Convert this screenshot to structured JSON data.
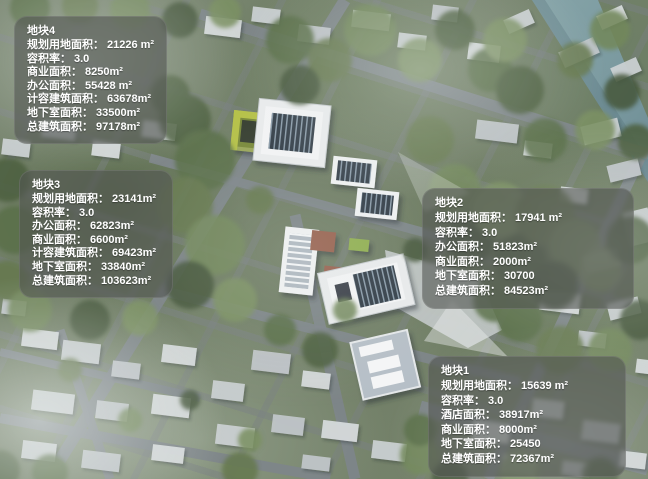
{
  "colors": {
    "overlay_box": "#525552",
    "water": "#7b9aa0",
    "accent_green_roof": "#a9b45a",
    "solar_panel": "#323d47"
  },
  "plots": [
    {
      "id": "plot-4",
      "title": "地块4",
      "rows": [
        {
          "label": "规划用地面积：",
          "value": "21226 m²"
        },
        {
          "label": "容积率：",
          "value": "3.0"
        },
        {
          "label": "商业面积：",
          "value": "8250m²"
        },
        {
          "label": "办公面积：",
          "value": "55428 m²"
        },
        {
          "label": "计容建筑面积：",
          "value": "63678m²"
        },
        {
          "label": "地下室面积：",
          "value": "33500m²"
        },
        {
          "label": "总建筑面积：",
          "value": "97178m²"
        }
      ]
    },
    {
      "id": "plot-3",
      "title": "地块3",
      "rows": [
        {
          "label": "规划用地面积：",
          "value": "23141m²"
        },
        {
          "label": "容积率：",
          "value": "3.0"
        },
        {
          "label": "办公面积：",
          "value": "62823m²"
        },
        {
          "label": "商业面积：",
          "value": "6600m²"
        },
        {
          "label": "计容建筑面积：",
          "value": "69423m²"
        },
        {
          "label": "地下室面积：",
          "value": "33840m²"
        },
        {
          "label": "总建筑面积：",
          "value": "103623m²"
        }
      ]
    },
    {
      "id": "plot-2",
      "title": "地块2",
      "rows": [
        {
          "label": "规划用地面积：",
          "value": "17941 m²"
        },
        {
          "label": "容积率：",
          "value": "3.0"
        },
        {
          "label": "办公面积：",
          "value": "51823m²"
        },
        {
          "label": "商业面积：",
          "value": "2000m²"
        },
        {
          "label": "地下室面积：",
          "value": "30700"
        },
        {
          "label": "总建筑面积：",
          "value": "84523m²"
        }
      ]
    },
    {
      "id": "plot-1",
      "title": "地块1",
      "rows": [
        {
          "label": "规划用地面积：",
          "value": "15639 m²"
        },
        {
          "label": "容积率：",
          "value": "3.0"
        },
        {
          "label": "酒店面积：",
          "value": "38917m²"
        },
        {
          "label": "商业面积：",
          "value": "8000m²"
        },
        {
          "label": "地下室面积：",
          "value": "25450"
        },
        {
          "label": "总建筑面积：",
          "value": "72367m²"
        }
      ]
    }
  ]
}
